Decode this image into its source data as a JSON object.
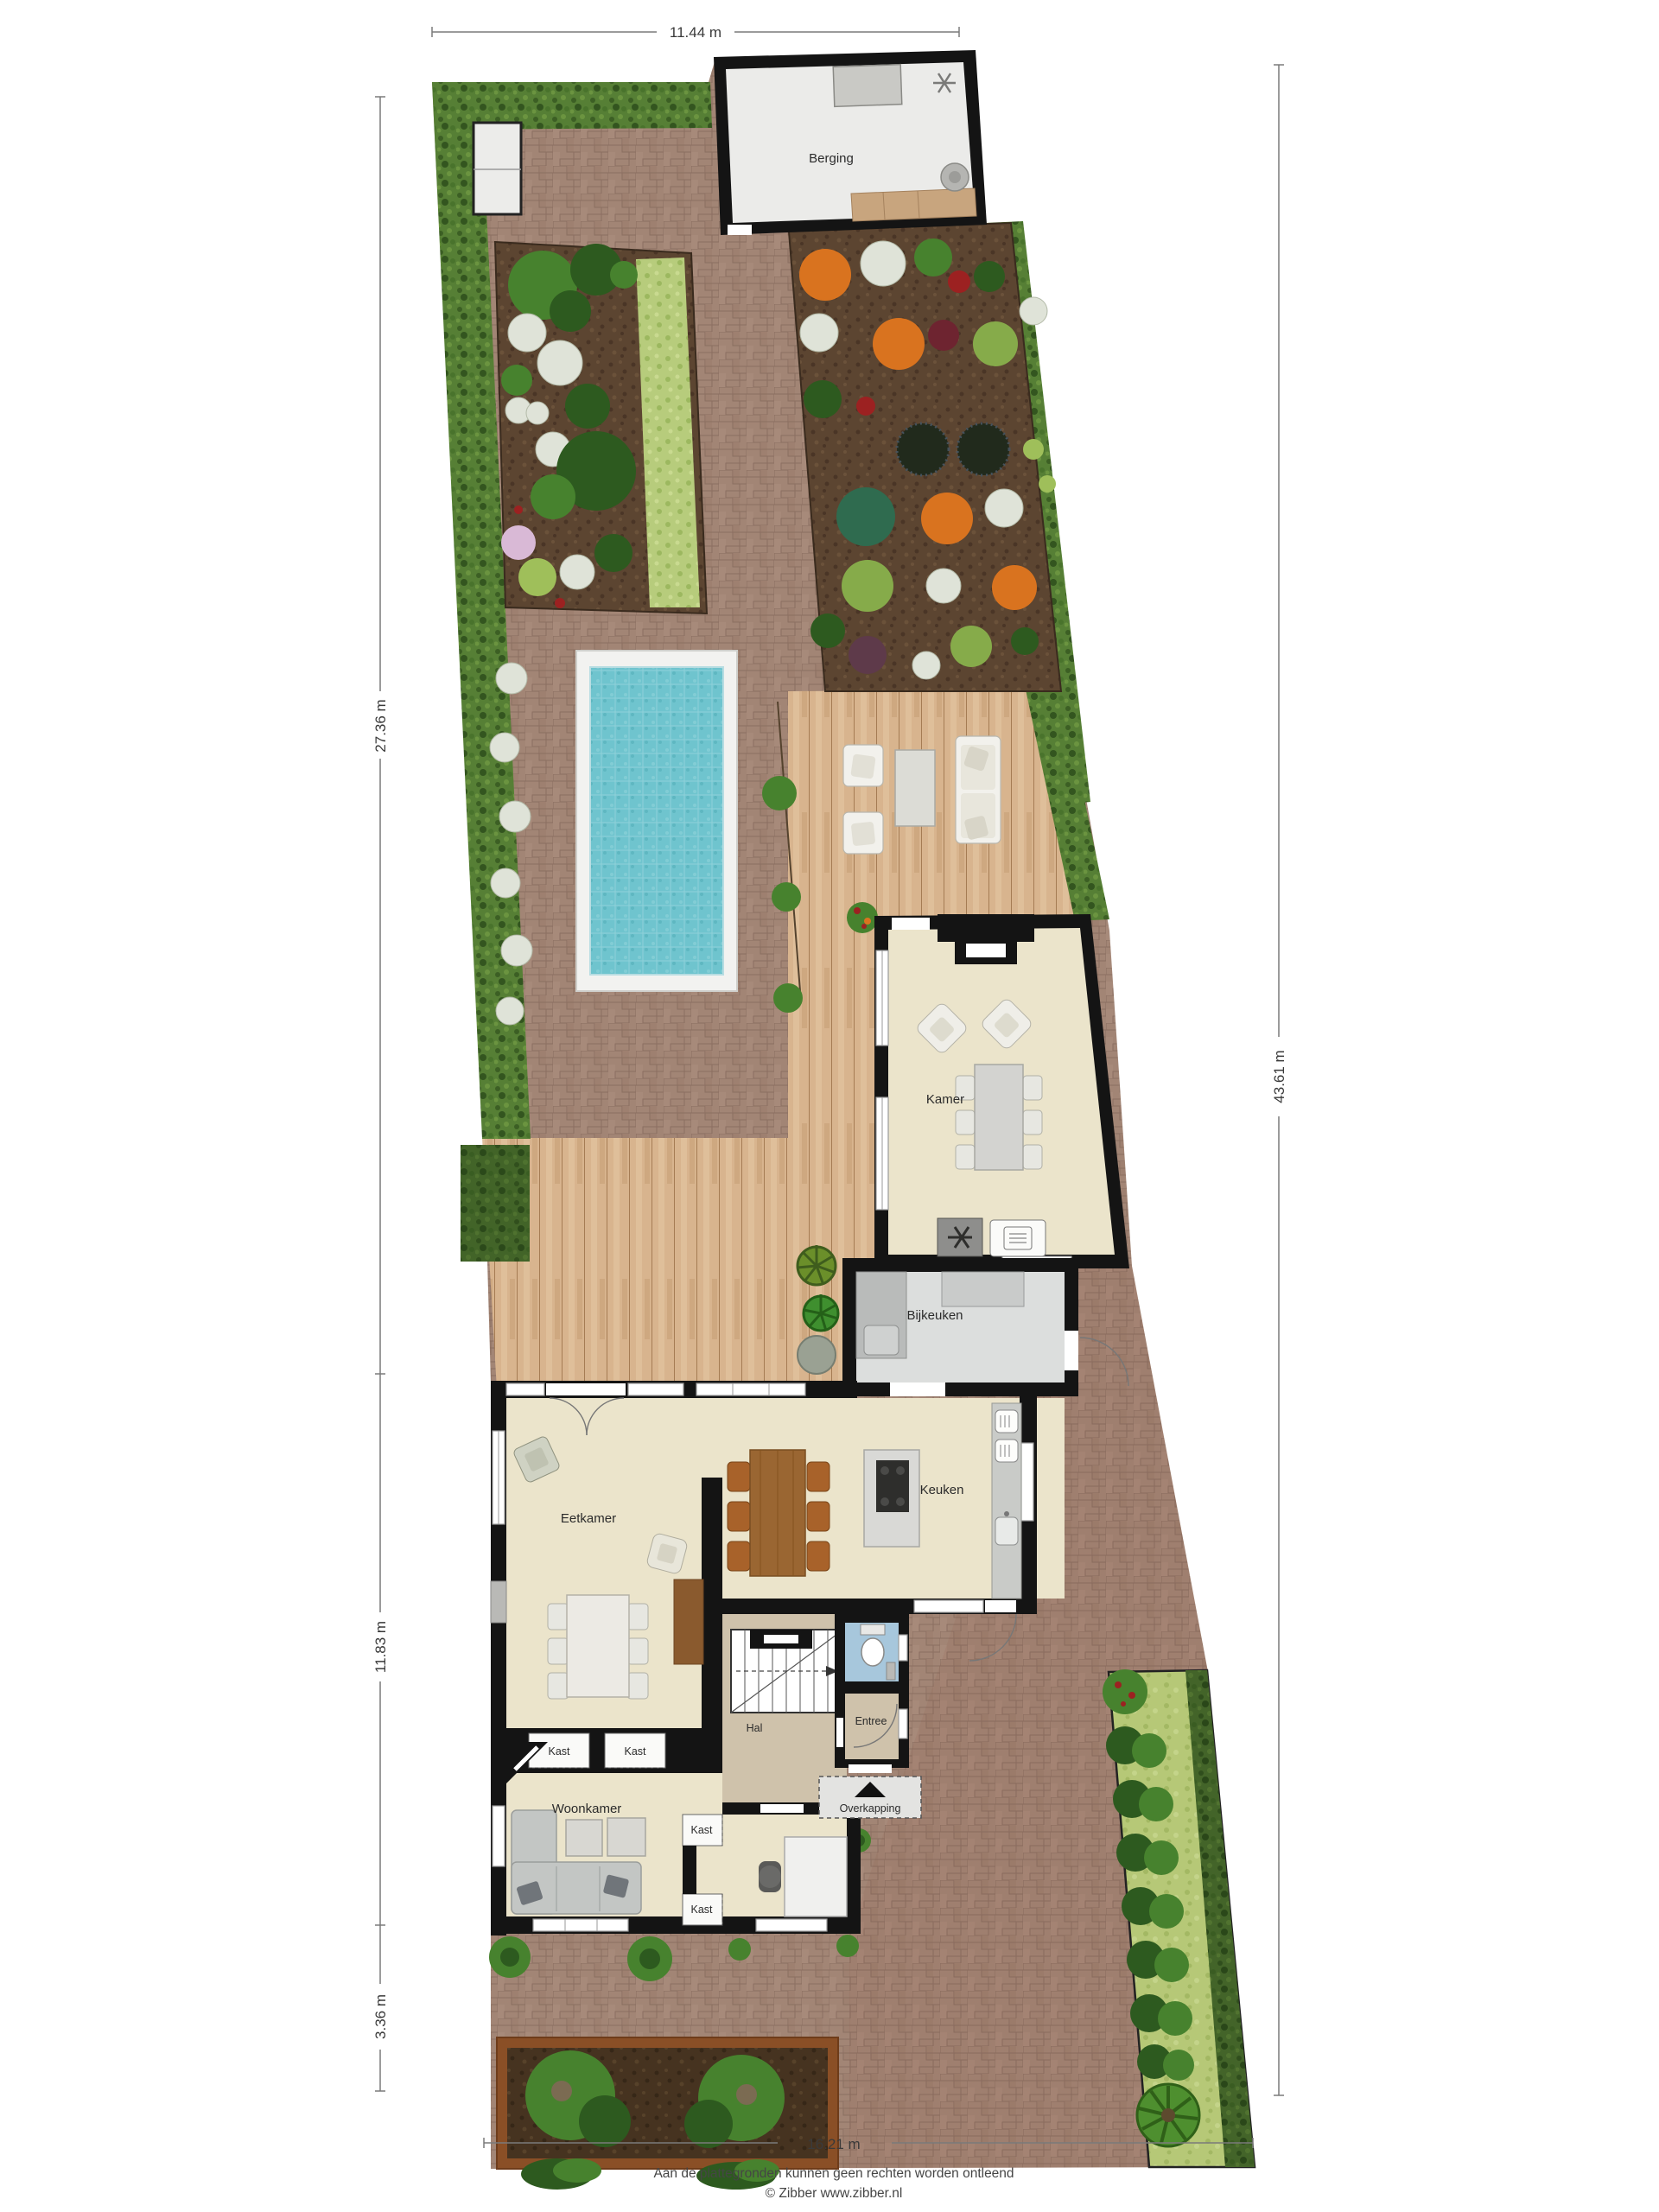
{
  "plan": {
    "dimensions": {
      "top": "11.44 m",
      "left_upper": "27.36 m",
      "left_middle": "11.83 m",
      "left_lower": "3.36 m",
      "right": "43.61 m",
      "bottom": "16.21 m"
    },
    "rooms": {
      "berging": "Berging",
      "kamer": "Kamer",
      "bijkeuken": "Bijkeuken",
      "keuken": "Keuken",
      "eetkamer": "Eetkamer",
      "hal": "Hal",
      "entree": "Entree",
      "overkapping": "Overkapping",
      "woonkamer": "Woonkamer",
      "kast_wall_left": "Kast",
      "kast_wall_right": "Kast",
      "kast_study_top": "Kast",
      "kast_study_bottom": "Kast"
    },
    "footer": {
      "disclaimer": "Aan de plattegronden kunnen geen rechten worden ontleend",
      "copyright": "© Zibber www.zibber.nl"
    },
    "colors": {
      "brick": "#a28575",
      "deck": "#d8b48e",
      "hedge": "#567f35",
      "soil": "#5c4531",
      "pool": "#6fc4ce",
      "room_floor": "#ebe4cb",
      "hal_floor": "#cfc2ab",
      "wc_floor": "#a7c7dc",
      "gray_floor": "#dcdedd",
      "grass": "#b6c877"
    }
  }
}
